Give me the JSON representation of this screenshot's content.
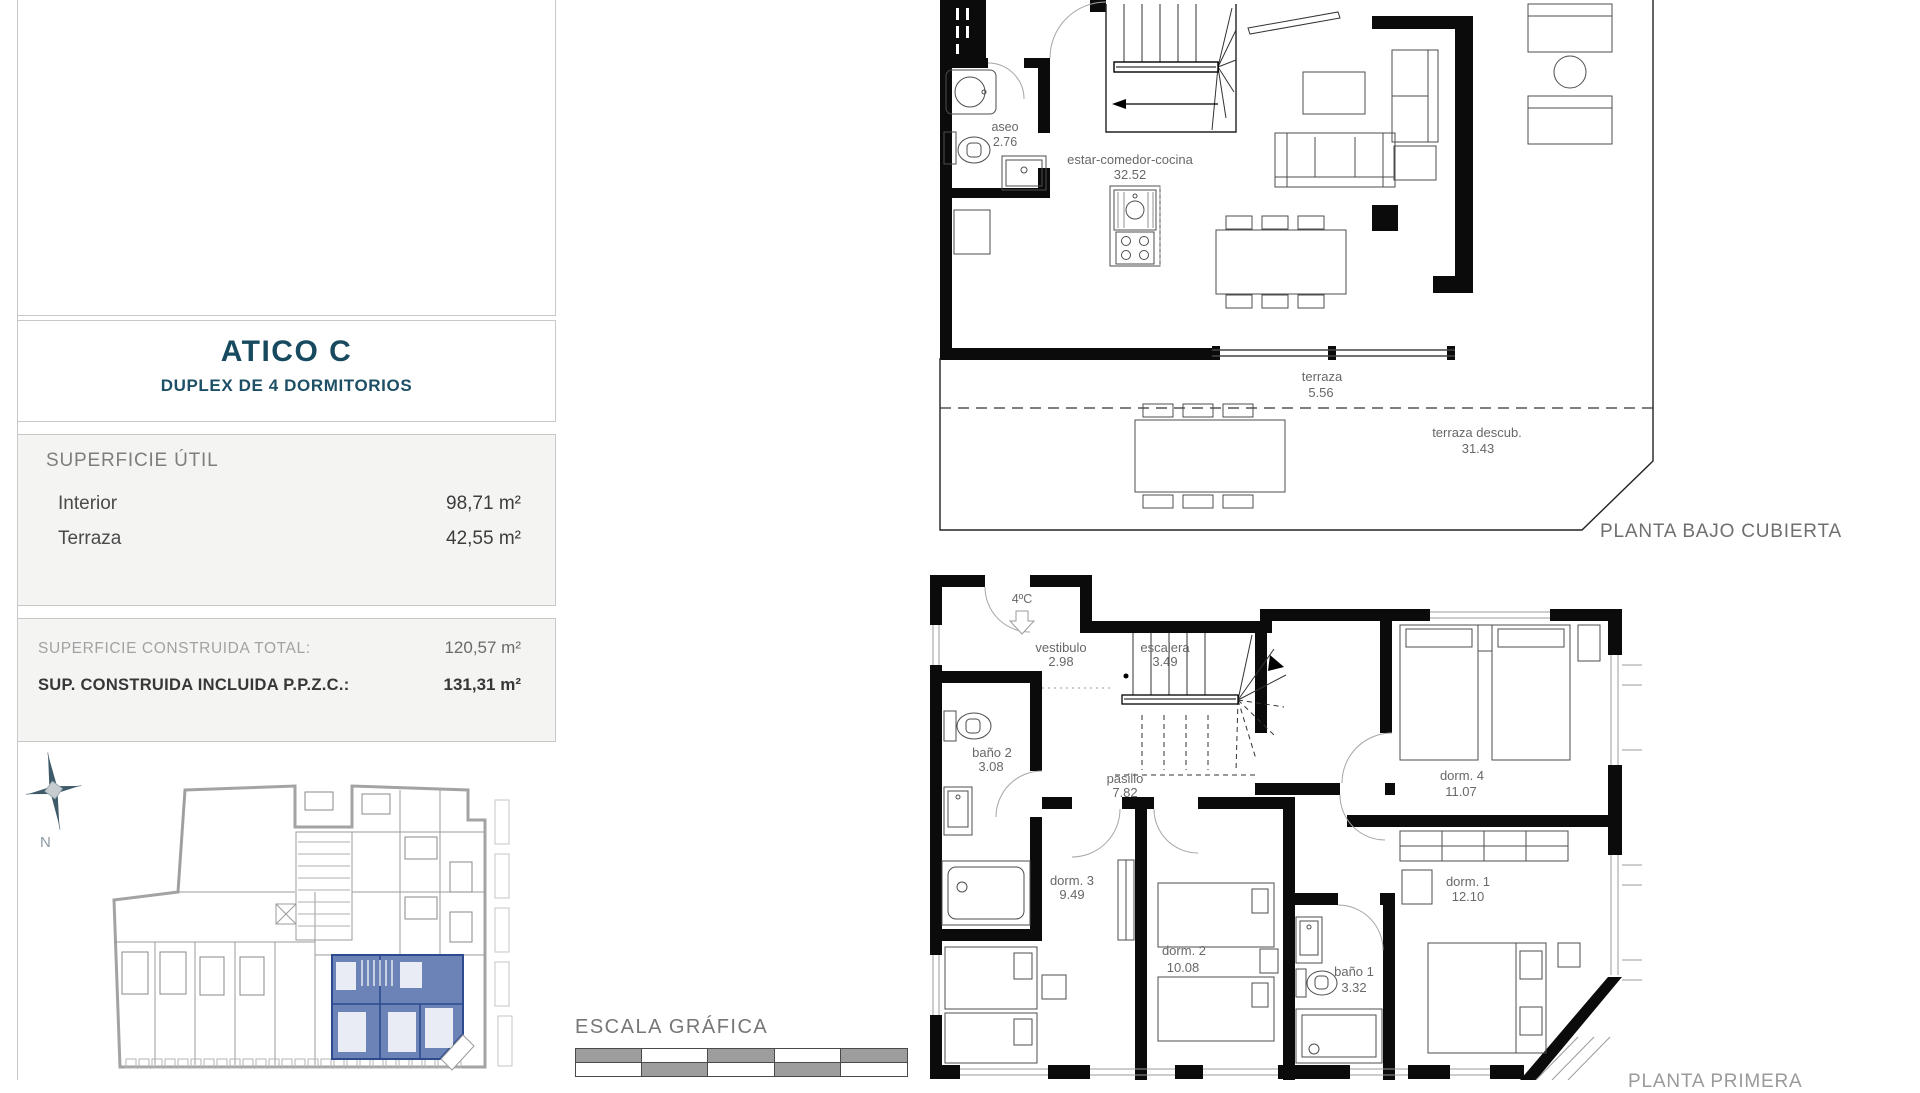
{
  "unit_card": {
    "title": "ATICO C",
    "subtitle": "DUPLEX DE 4 DORMITORIOS",
    "superficie_util": {
      "heading": "SUPERFICIE ÚTIL",
      "rows": [
        {
          "label": "Interior",
          "value": "98,71 m²"
        },
        {
          "label": "Terraza",
          "value": "42,55 m²"
        }
      ]
    },
    "superficie_construida": {
      "rows": [
        {
          "label": "SUPERFICIE CONSTRUIDA TOTAL:",
          "value": "120,57 m²"
        },
        {
          "label": "SUP. CONSTRUIDA INCLUIDA P.P.Z.C.:",
          "value": "131,31 m²"
        }
      ]
    },
    "compass": {
      "label": "N"
    }
  },
  "scale_bar": {
    "label": "ESCALA GRÁFICA"
  },
  "upper_plan": {
    "caption": "PLANTA BAJO CUBIERTA",
    "rooms": [
      {
        "name": "aseo",
        "value": "2.76"
      },
      {
        "name": "estar-comedor-cocina",
        "value": "32.52"
      },
      {
        "name": "terraza",
        "value": "5.56"
      },
      {
        "name": "terraza descub.",
        "value": "31.43"
      }
    ]
  },
  "lower_plan": {
    "caption": "PLANTA PRIMERA",
    "entry_label": "4ºC",
    "rooms": [
      {
        "name": "vestibulo",
        "value": "2.98"
      },
      {
        "name": "escalera",
        "value": "3.49"
      },
      {
        "name": "baño 2",
        "value": "3.08"
      },
      {
        "name": "pasillo",
        "value": "7.82"
      },
      {
        "name": "dorm. 4",
        "value": "11.07"
      },
      {
        "name": "dorm. 3",
        "value": "9.49"
      },
      {
        "name": "dorm. 2",
        "value": "10.08"
      },
      {
        "name": "baño 1",
        "value": "3.32"
      },
      {
        "name": "dorm. 1",
        "value": "12.10"
      }
    ]
  },
  "colors": {
    "accent": "#17495f",
    "highlight": "#5872ae"
  }
}
